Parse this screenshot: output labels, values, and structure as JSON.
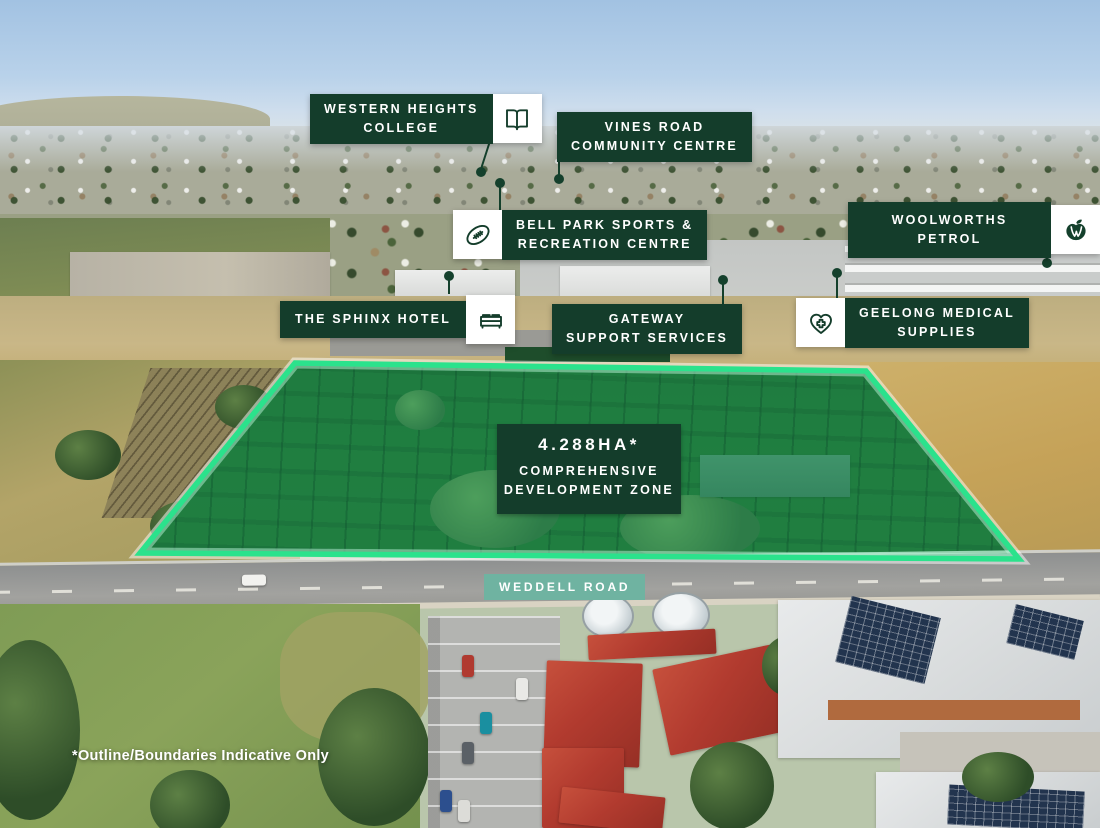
{
  "colors": {
    "label_bg": "#143D2B",
    "label_text": "#FFFFFF",
    "road_label_bg": "#6FB3A1",
    "site_outline": "#2BE28C",
    "site_fill": "rgba(47,222,141,0.33)"
  },
  "callouts": [
    {
      "name": "western-heights-college",
      "text": "WESTERN HEIGHTS\nCOLLEGE",
      "icon": "book-icon",
      "icon_side": "right"
    },
    {
      "name": "vines-road-community-centre",
      "text": "VINES ROAD\nCOMMUNITY CENTRE",
      "icon": null,
      "icon_side": "none"
    },
    {
      "name": "bell-park-sports-recreation-centre",
      "text": "BELL PARK SPORTS &\nRECREATION CENTRE",
      "icon": "football-icon",
      "icon_side": "left"
    },
    {
      "name": "woolworths-petrol",
      "text": "WOOLWORTHS PETROL",
      "icon": "woolworths-logo-icon",
      "icon_side": "right"
    },
    {
      "name": "the-sphinx-hotel",
      "text": "THE SPHINX HOTEL",
      "icon": "bed-icon",
      "icon_side": "right"
    },
    {
      "name": "gateway-support-services",
      "text": "GATEWAY\nSUPPORT SERVICES",
      "icon": null,
      "icon_side": "none"
    },
    {
      "name": "geelong-medical-supplies",
      "text": "GEELONG MEDICAL\nSUPPLIES",
      "icon": "heart-medical-icon",
      "icon_side": "left"
    }
  ],
  "site": {
    "area": "4.288HA*",
    "zone": "COMPREHENSIVE\nDEVELOPMENT ZONE"
  },
  "road": {
    "name": "WEDDELL ROAD"
  },
  "disclaimer": "*Outline/Boundaries Indicative Only"
}
